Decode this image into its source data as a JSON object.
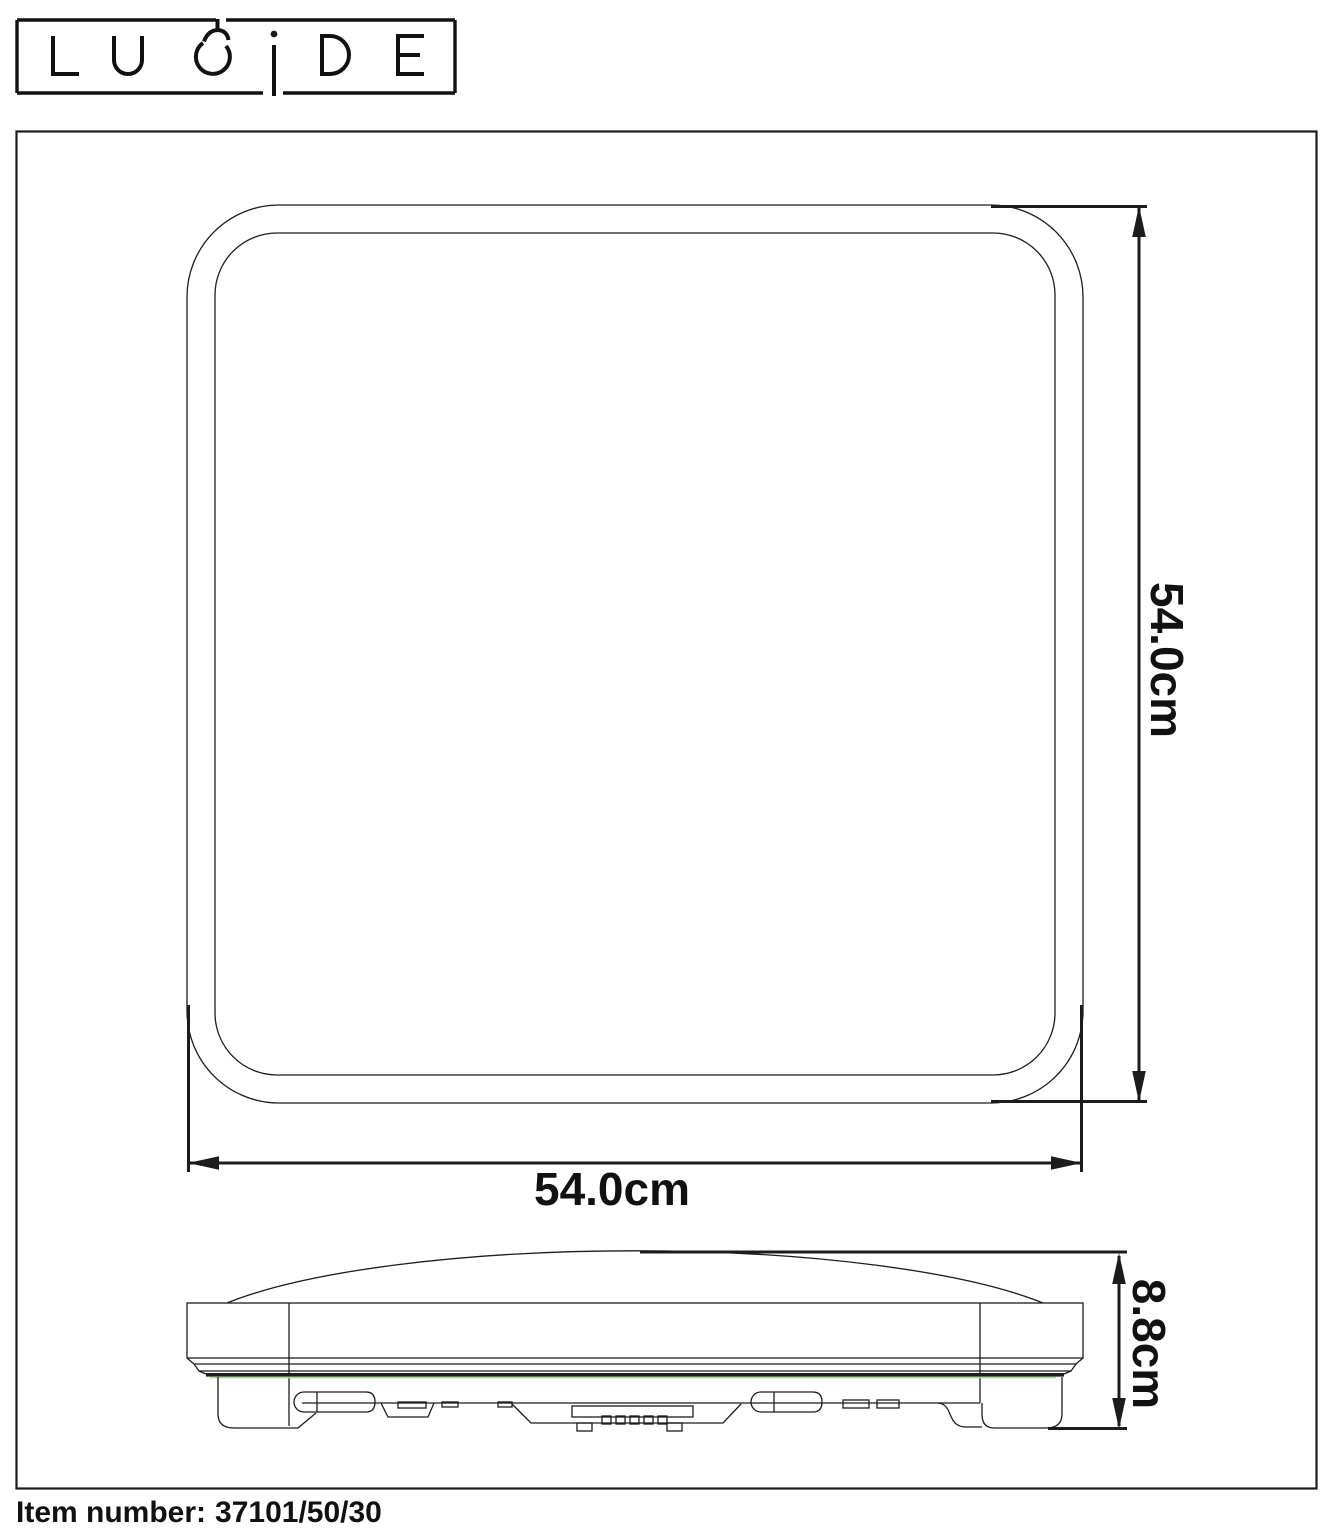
{
  "brand": {
    "name": "LUCIDE"
  },
  "dimensions": {
    "top_view_width": "54.0cm",
    "top_view_height": "54.0cm",
    "side_view_height": "8.8cm"
  },
  "footer": {
    "label": "Item number:",
    "value": "37101/50/30"
  },
  "colors": {
    "ink": "#1c1c1c",
    "background": "#ffffff",
    "gasket_green": "#aed39a"
  }
}
